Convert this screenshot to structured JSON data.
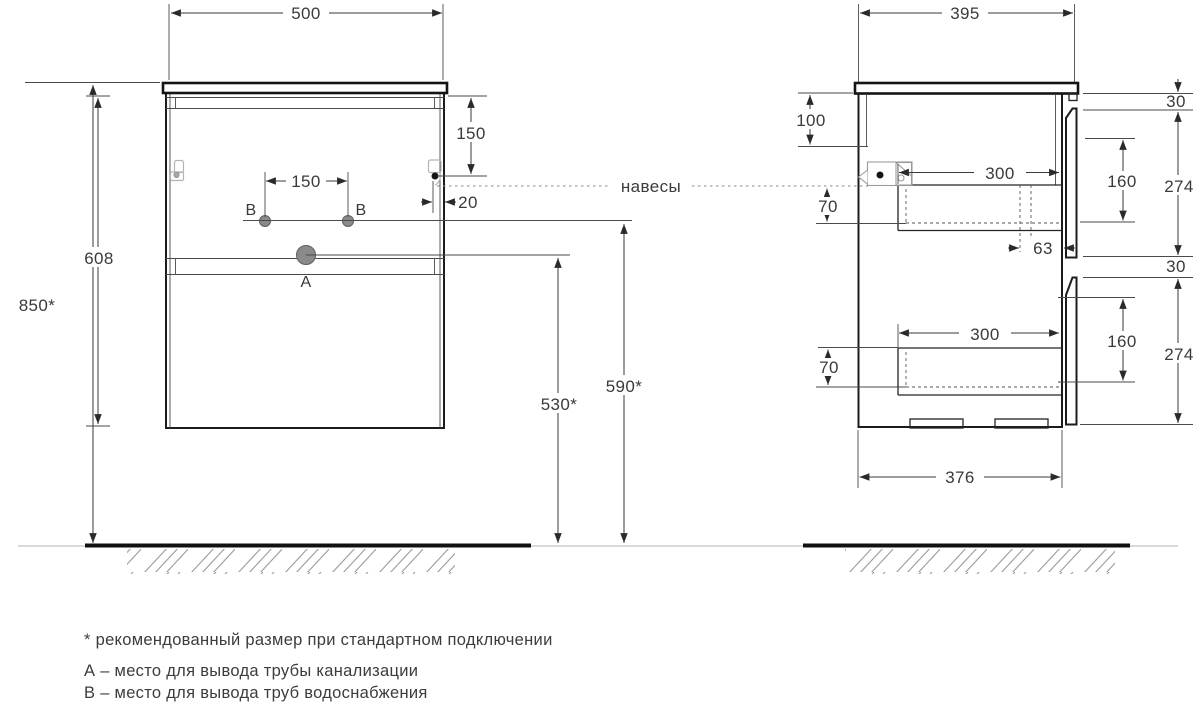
{
  "front_view": {
    "width": "500",
    "height_total": "850*",
    "height_carcass": "608",
    "hanger_top_offset": "150",
    "outlet_spacing": "150",
    "hanger_side_offset": "20",
    "outlet_a_height": "530*",
    "outlet_b_height": "590*",
    "label_a": "A",
    "label_b_left": "B",
    "label_b_right": "B"
  },
  "side_view": {
    "depth": "395",
    "back_rail_height": "100",
    "gap_top": "30",
    "gap_mid": "30",
    "drawer_face_height_top": "274",
    "drawer_face_height_bottom": "274",
    "drawer_inner_height_top": "160",
    "drawer_inner_height_bottom": "160",
    "drawer_depth_top": "300",
    "drawer_depth_bottom": "300",
    "hanger_drop_top": "70",
    "hanger_drop_bottom": "70",
    "siphon_offset": "63",
    "bottom_depth": "376"
  },
  "annotations": {
    "hangers_label": "навесы"
  },
  "notes": {
    "line1": "* рекомендованный размер при стандартном подключении",
    "line2": "А – место для вывода трубы канализации",
    "line3": "В – место для вывода труб водоснабжения"
  },
  "colors": {
    "line": "#232323",
    "dimension": "#3a3a3a",
    "icon_gray": "#b3b3b3",
    "point_fill": "#8a8a8a",
    "floor": "#111111"
  }
}
